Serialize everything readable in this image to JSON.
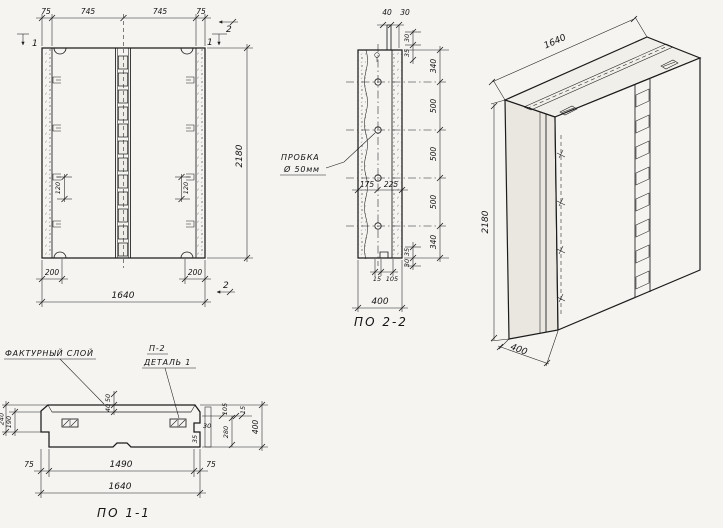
{
  "front": {
    "t75a": "75",
    "t745a": "745",
    "t745b": "745",
    "t75b": "75",
    "height": "2180",
    "left200": "200",
    "right200": "200",
    "total": "1640",
    "left120": "120",
    "right120": "120",
    "mark1tl": "1",
    "mark2tr": "2",
    "mark1tr": "1",
    "mark2br": "2"
  },
  "s22": {
    "caption": "ПО 2-2",
    "top40": "40",
    "top30": "30",
    "off30t": "30",
    "off35t": "35",
    "c0": "340",
    "c1": "500",
    "c2": "500",
    "c3": "500",
    "c4": "340",
    "mid175": "175",
    "mid225": "225",
    "off35b": "35",
    "off30b": "30",
    "b15": "15",
    "b105": "105",
    "total": "400",
    "plug1": "ПРОБКА",
    "plug2": "Ø 50мм"
  },
  "iso": {
    "w": "1640",
    "h": "2180",
    "d": "400"
  },
  "s11": {
    "caption": "ПО 1-1",
    "facture": "ФАКТУРНЫЙ СЛОЙ",
    "ref": "П-2",
    "detail": "ДЕТАЛЬ 1",
    "l50": "50",
    "l40": "40",
    "d190": "190",
    "d240": "240",
    "r105": "105",
    "r15": "15",
    "r30": "30",
    "r35": "35",
    "d280": "280",
    "d400": "400",
    "b75a": "75",
    "b1490": "1490",
    "b75b": "75",
    "total": "1640"
  }
}
